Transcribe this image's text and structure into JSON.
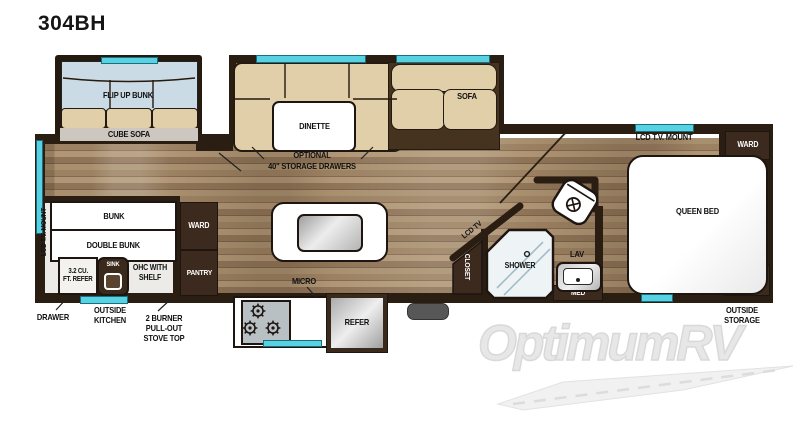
{
  "title": "304BH",
  "watermark": "OptimumRV",
  "colors": {
    "accent_cyan": "#58d2e2",
    "wall": "#2a1d12",
    "cabinet": "#3b2a1d",
    "cushion": "#e0cfa9",
    "bunk_blue": "#cadbe6"
  },
  "front_bunk": {
    "flip_up_bunk": "FLIP UP BUNK",
    "cube_sofa": "CUBE SOFA"
  },
  "dinette_area": {
    "dinette": "DINETTE",
    "optional_line1": "OPTIONAL",
    "optional_line2": "40\" STORAGE DRAWERS",
    "sofa": "SOFA"
  },
  "bedroom": {
    "lcd_tv_mount": "LCD T.V. MOUNT",
    "ward_top": "WARD",
    "ward_bottom": "WARD",
    "queen_bed": "QUEEN BED",
    "outside_storage_line1": "OUTSIDE",
    "outside_storage_line2": "STORAGE"
  },
  "bathroom": {
    "shower": "SHOWER",
    "lav": "LAV",
    "med": "MED",
    "closet": "CLOSET",
    "lcd_tv": "LCD TV"
  },
  "bunk_room": {
    "lcd_tv_mount": "LCD T.V. MOUNT",
    "bunk": "BUNK",
    "double_bunk": "DOUBLE BUNK",
    "refer_line1": "3.2 CU.",
    "refer_line2": "FT. REFER",
    "sink": "SINK",
    "ohc_line1": "OHC WITH",
    "ohc_line2": "SHELF",
    "ward": "WARD",
    "pantry": "PANTRY"
  },
  "kitchen": {
    "micro": "MICRO",
    "refer": "REFER"
  },
  "callouts": {
    "drawer": "DRAWER",
    "outside_kitchen_line1": "OUTSIDE",
    "outside_kitchen_line2": "KITCHEN",
    "stove_line1": "2 BURNER",
    "stove_line2": "PULL-OUT",
    "stove_line3": "STOVE TOP"
  }
}
